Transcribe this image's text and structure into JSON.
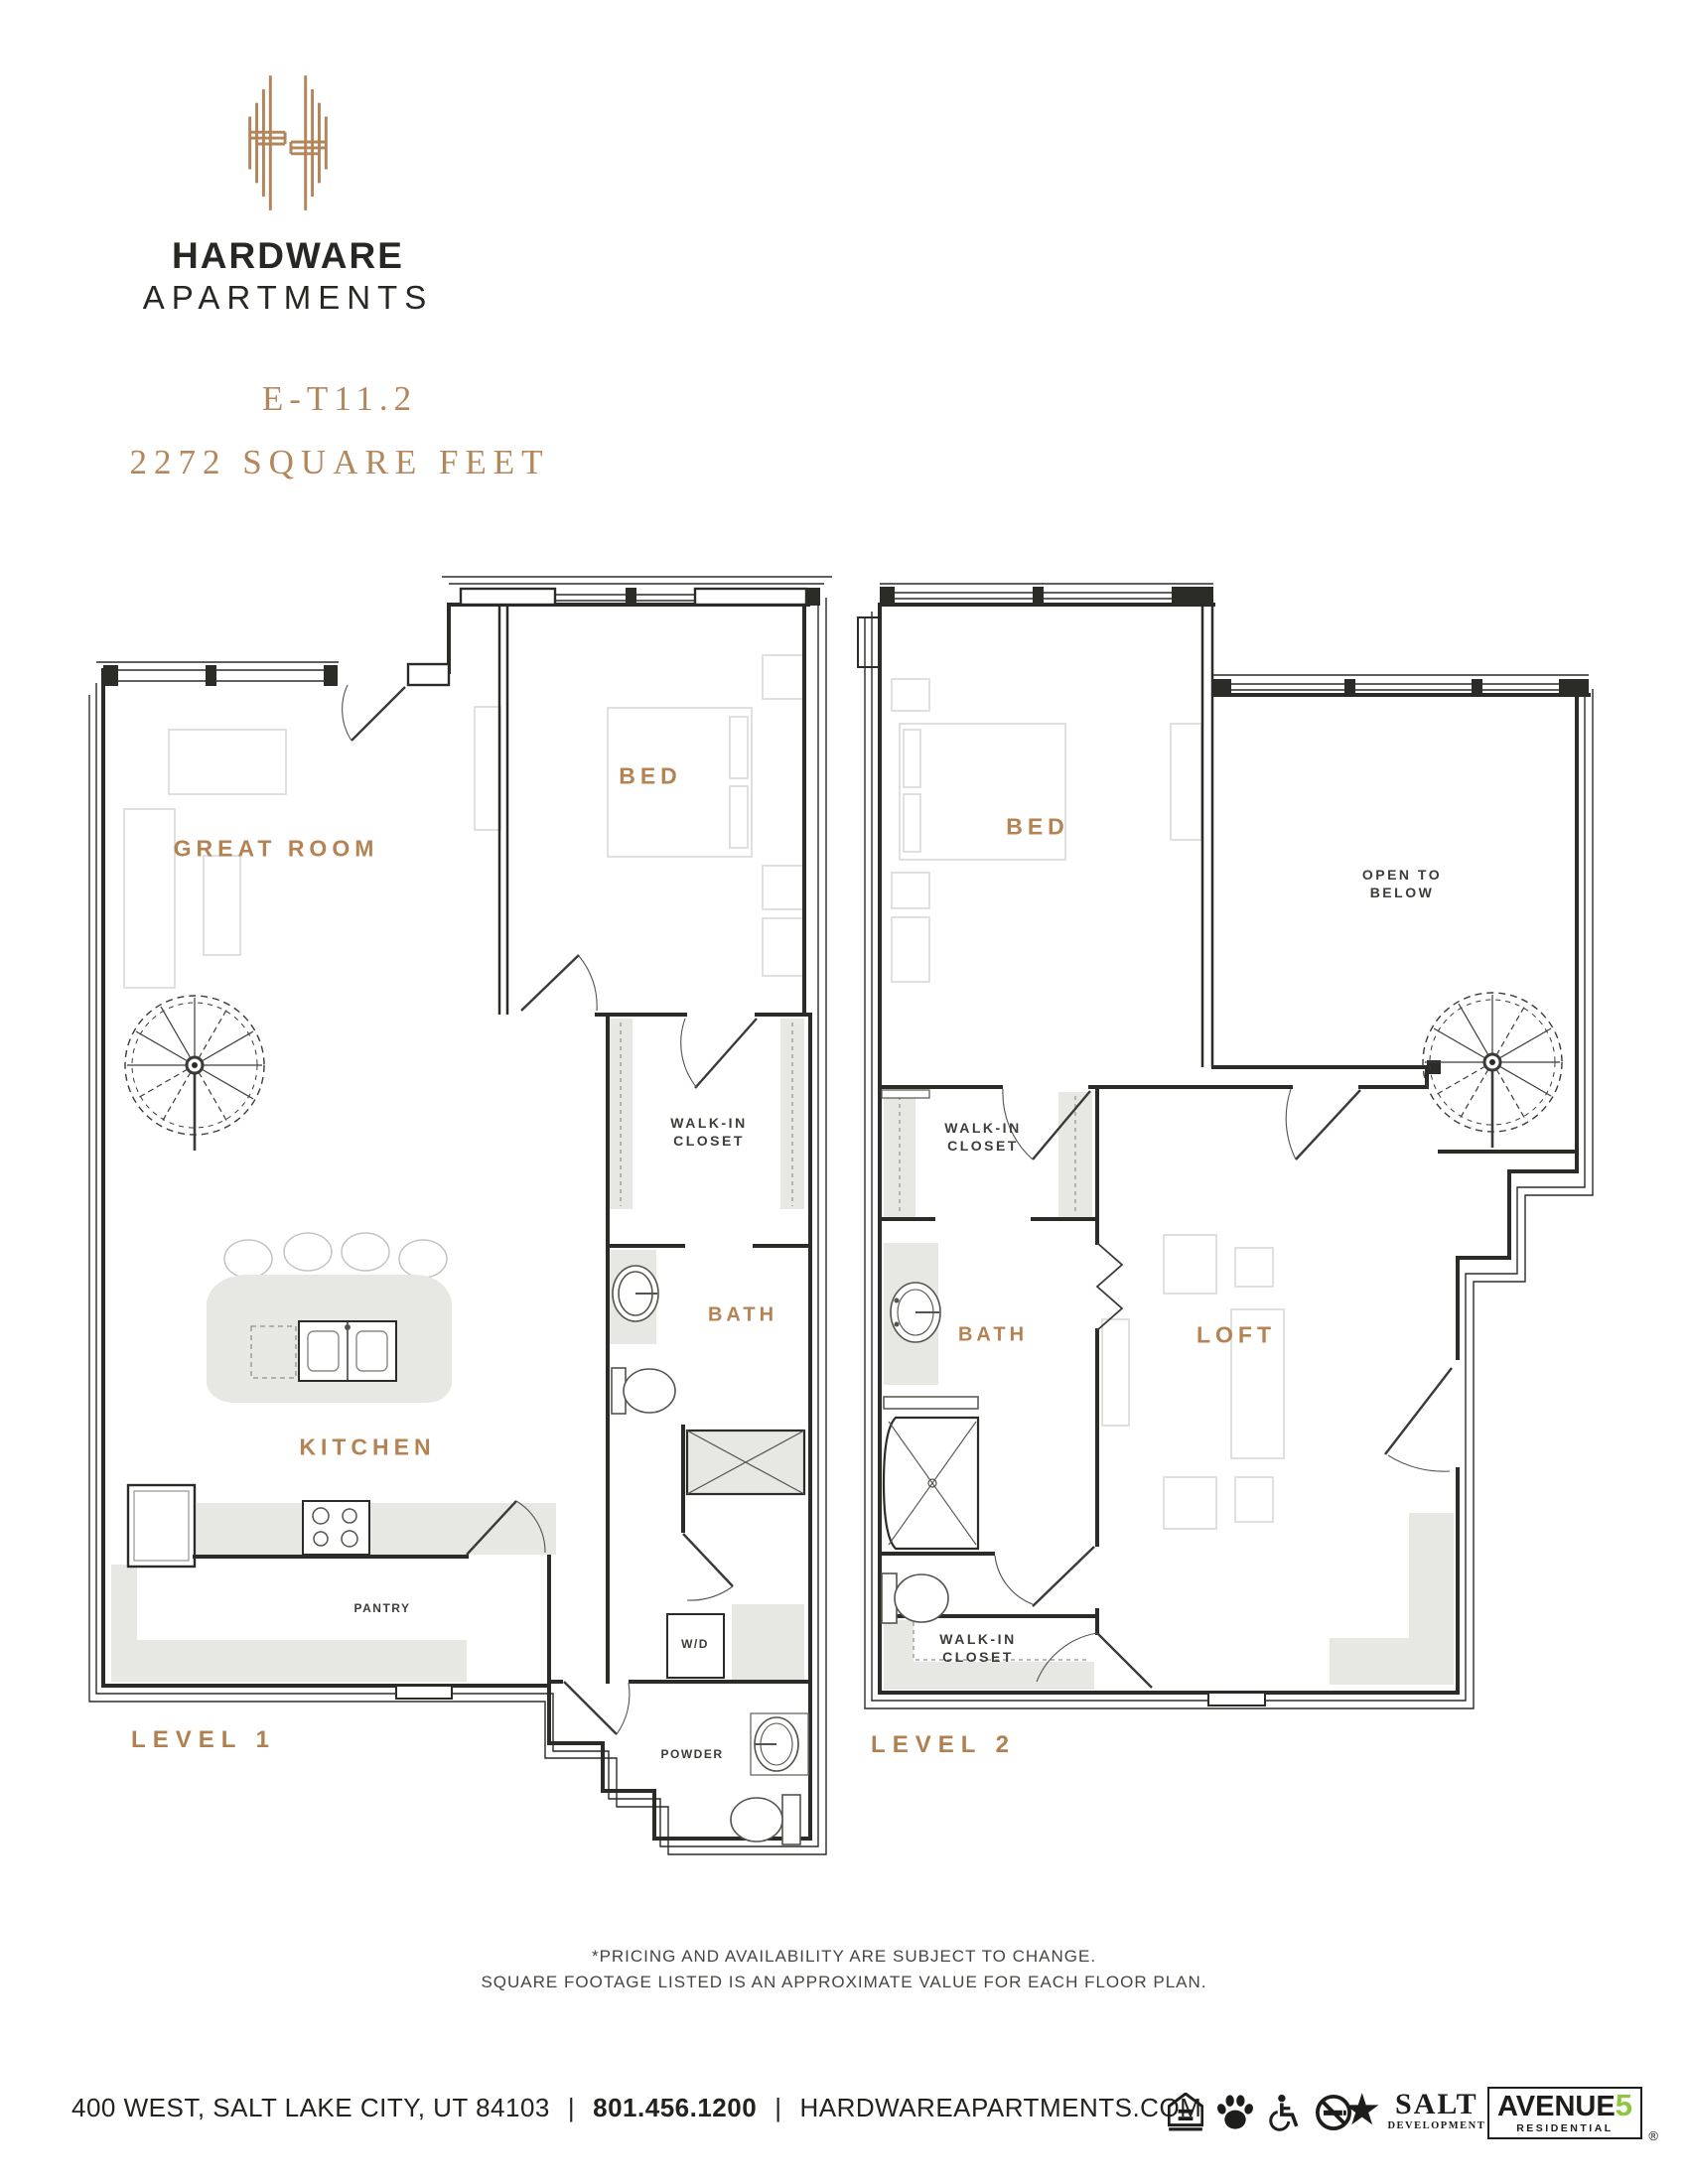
{
  "brand": {
    "logo_icon": "hardware-h-monogram-icon",
    "name_line1": "HARDWARE",
    "name_line2": "APARTMENTS"
  },
  "plan": {
    "code": "E-T11.2",
    "area": "2272 SQUARE FEET"
  },
  "levels": [
    {
      "name": "LEVEL 1",
      "labels": {
        "great_room": "GREAT ROOM",
        "bed": "BED",
        "walk_in_closet_line1": "WALK-IN",
        "walk_in_closet_line2": "CLOSET",
        "bath": "BATH",
        "kitchen": "KITCHEN",
        "pantry": "PANTRY",
        "washer_dryer": "W/D",
        "powder": "POWDER"
      }
    },
    {
      "name": "LEVEL 2",
      "labels": {
        "bed": "BED",
        "open_to_below_line1": "OPEN TO",
        "open_to_below_line2": "BELOW",
        "walk_in_closet_upper_line1": "WALK-IN",
        "walk_in_closet_upper_line2": "CLOSET",
        "bath": "BATH",
        "loft": "LOFT",
        "walk_in_closet_lower_line1": "WALK-IN",
        "walk_in_closet_lower_line2": "CLOSET"
      }
    }
  ],
  "disclaimer": {
    "line1": "*PRICING AND AVAILABILITY ARE SUBJECT TO CHANGE.",
    "line2": "SQUARE FOOTAGE LISTED IS AN APPROXIMATE VALUE FOR EACH FLOOR PLAN."
  },
  "footer": {
    "address": "400 WEST, SALT LAKE CITY, UT 84103",
    "separator": "|",
    "phone": "801.456.1200",
    "website": "HARDWAREAPARTMENTS.COM",
    "icons": [
      "equal-housing-icon",
      "pet-friendly-icon",
      "accessible-icon",
      "no-smoking-icon"
    ],
    "salt": {
      "star": "★",
      "name": "SALT",
      "sub": "DEVELOPMENT"
    },
    "avenue5": {
      "name": "AVENUE",
      "five": "5",
      "sub": "RESIDENTIAL",
      "reg": "®"
    }
  },
  "colors": {
    "copper": "#b58353",
    "wall": "#2b2b28",
    "light_fill": "#e7e7e4",
    "furniture": "#d9d9d5",
    "avenue5_green": "#8dc63f"
  }
}
